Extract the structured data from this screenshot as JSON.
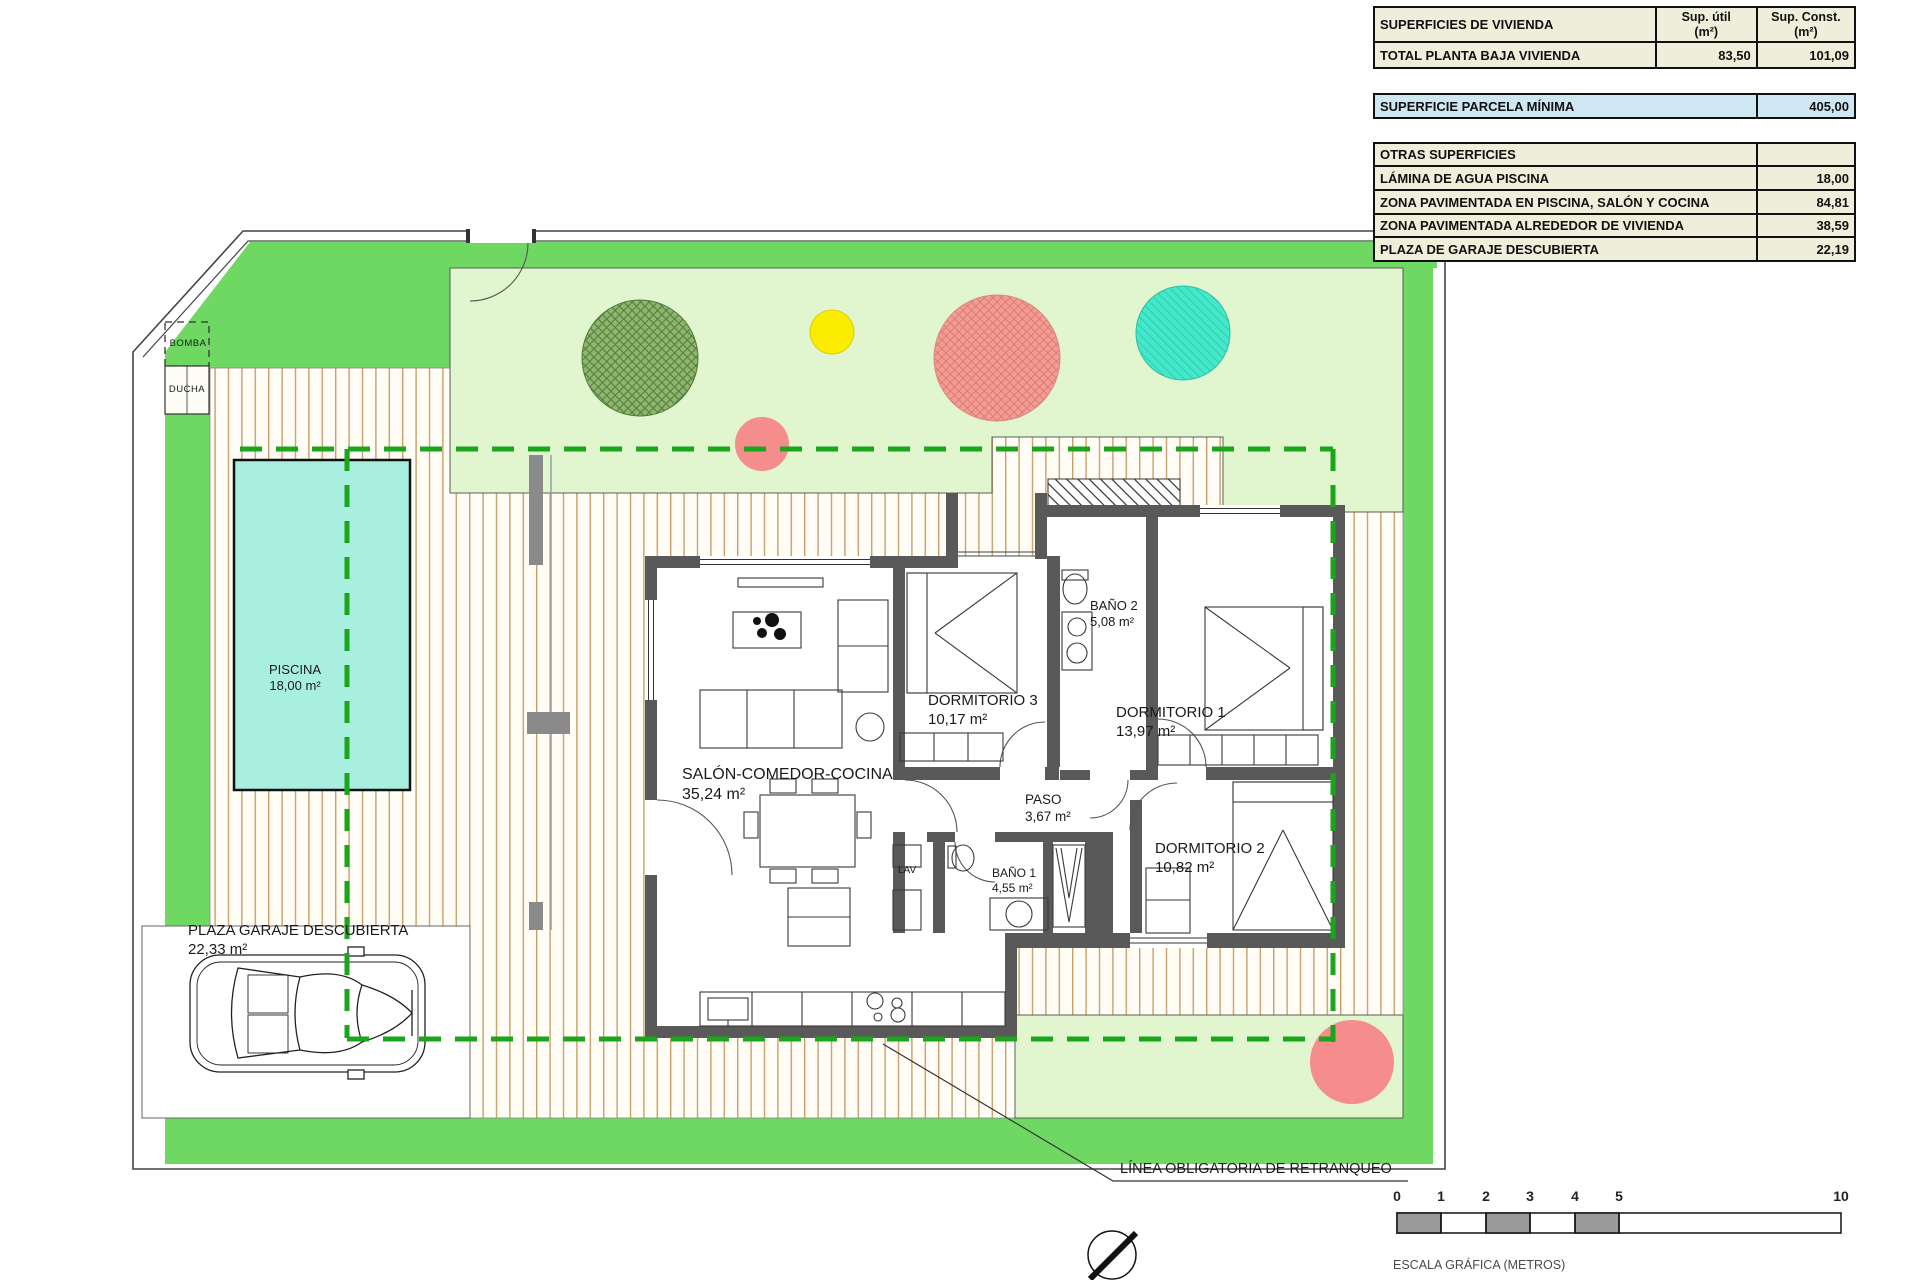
{
  "surfaces_table": {
    "col_headers": {
      "main": "SUPERFICIES DE VIVIENDA",
      "util_line1": "Sup. útil",
      "util_line2": "(m²)",
      "const_line1": "Sup. Const.",
      "const_line2": "(m²)"
    },
    "rows": {
      "total": {
        "label": "TOTAL PLANTA BAJA VIVIENDA",
        "util": "83,50",
        "const": "101,09"
      },
      "parcela": {
        "label": "SUPERFICIE PARCELA MÍNIMA",
        "const": "405,00"
      },
      "otras": {
        "label": "OTRAS SUPERFICIES"
      },
      "lamina": {
        "label": "LÁMINA DE AGUA PISCINA",
        "const": "18,00"
      },
      "zona_piscina": {
        "label": "ZONA PAVIMENTADA EN PISCINA, SALÓN Y COCINA",
        "const": "84,81"
      },
      "zona_vivienda": {
        "label": "ZONA PAVIMENTADA ALREDEDOR DE VIVIENDA",
        "const": "38,59"
      },
      "garaje": {
        "label": "PLAZA DE GARAJE DESCUBIERTA",
        "const": "22,19"
      }
    }
  },
  "rooms": {
    "piscina": {
      "name": "PISCINA",
      "area": "18,00 m²"
    },
    "salon": {
      "name": "SALÓN-COMEDOR-COCINA",
      "area": "35,24 m²"
    },
    "dormitorio3": {
      "name": "DORMITORIO 3",
      "area": "10,17 m²"
    },
    "banyo2": {
      "name": "BAÑO 2",
      "area": "5,08 m²"
    },
    "dormitorio1": {
      "name": "DORMITORIO 1",
      "area": "13,97 m²"
    },
    "paso": {
      "name": "PASO",
      "area": "3,67 m²"
    },
    "banyo1": {
      "name": "BAÑO 1",
      "area": "4,55 m²"
    },
    "dormitorio2": {
      "name": "DORMITORIO 2",
      "area": "10,82 m²"
    },
    "garaje": {
      "name": "PLAZA GARAJE DESCUBIERTA",
      "area": "22,33 m²"
    }
  },
  "annotations": {
    "bomba": "BOMBA",
    "ducha": "DUCHA",
    "lav": "LAV",
    "retranqueo": "LÍNEA OBLIGATORIA DE RETRANQUEO"
  },
  "scale_bar": {
    "ticks": [
      "0",
      "1",
      "2",
      "3",
      "4",
      "5",
      "10"
    ],
    "caption": "ESCALA GRÁFICA (METROS)"
  },
  "colors": {
    "grass": "#6ed862",
    "lawn_light": "#e1f5cf",
    "pool_water": "#a9efdf",
    "retranqueo_line": "#1aa51a",
    "wall": "#595959",
    "deck_stripe": "#c9a06a",
    "table_row": "#eeeedb",
    "table_highlight": "#cfe7f2",
    "tree_green": "#8fb56e",
    "tree_pink": "#f19d96",
    "tree_teal": "#45e8ca",
    "tree_yellow": "#fced00"
  }
}
